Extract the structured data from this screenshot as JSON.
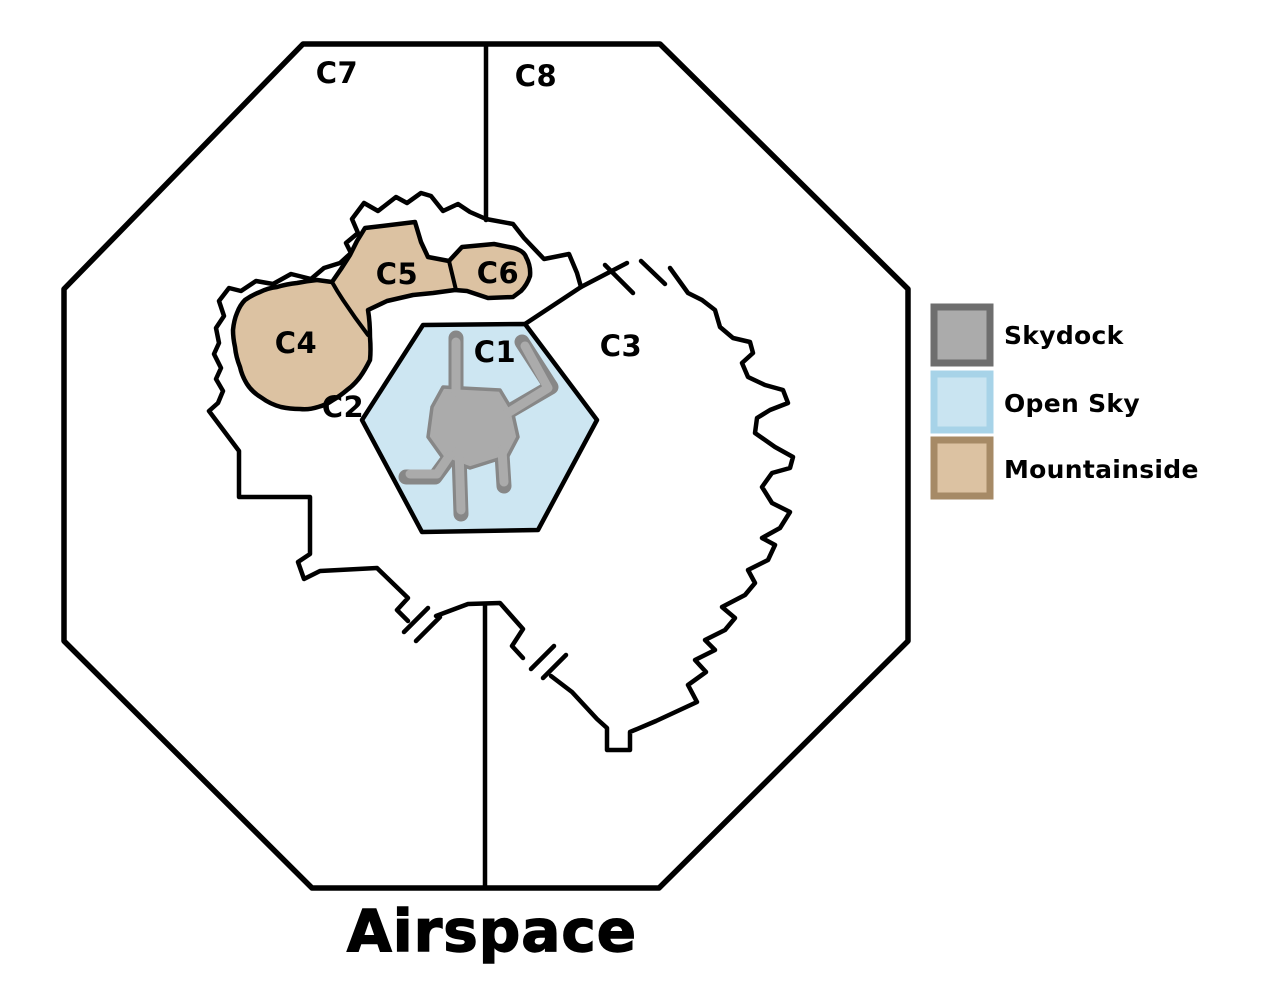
{
  "title": "Airspace",
  "regions": {
    "c1": "C1",
    "c2": "C2",
    "c3": "C3",
    "c4": "C4",
    "c5": "C5",
    "c6": "C6",
    "c7": "C7",
    "c8": "C8"
  },
  "legend": {
    "items": [
      {
        "label": "Skydock",
        "fill": "#ABABAB",
        "border": "#6E6E6E"
      },
      {
        "label": "Open Sky",
        "fill": "#C9E4F1",
        "border": "#A7D3E8"
      },
      {
        "label": "Mountainside",
        "fill": "#DCC2A2",
        "border": "#A68A66"
      }
    ]
  },
  "colors": {
    "map_fill": "#CDE6F2",
    "outline": "#000000",
    "mountain_fill": "#DCC2A2",
    "skydock_fill": "#ABABAB",
    "skydock_outline": "#878787",
    "background": "#FFFFFF"
  }
}
